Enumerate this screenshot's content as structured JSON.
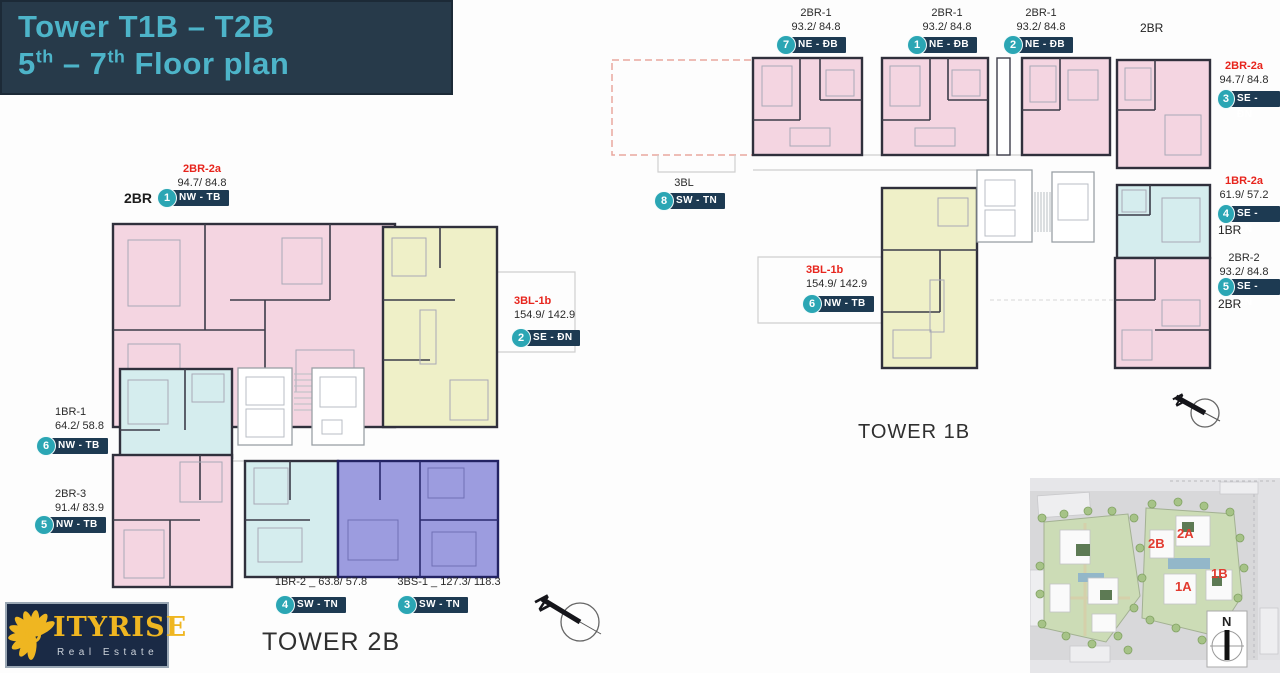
{
  "title": {
    "l1": "Tower T1B – T2B",
    "l2a": "5",
    "l2sup1": "th",
    "l2b": " – 7",
    "l2sup2": "th",
    "l2c": " Floor plan"
  },
  "north_letter": "N",
  "towers": {
    "t2b": {
      "name": "TOWER 2B",
      "labels": [
        {
          "code": "2BR-2a",
          "area": "94.7/ 84.8",
          "prefix": "2BR",
          "badge": "1",
          "dir": "NW - TB"
        },
        {
          "code": "3BL-1b",
          "area": "154.9/ 142.9",
          "badge": "2",
          "dir": "SE - ĐN"
        },
        {
          "code": "3BS-1 _ 127.3/ 118.3",
          "badge": "3",
          "dir": "SW - TN"
        },
        {
          "code": "1BR-2 _ 63.8/ 57.8",
          "badge": "4",
          "dir": "SW - TN"
        },
        {
          "code": "2BR-3",
          "area": "91.4/ 83.9",
          "badge": "5",
          "dir": "NW - TB"
        },
        {
          "code": "1BR-1",
          "area": "64.2/ 58.8",
          "badge": "6",
          "dir": "NW - TB"
        }
      ]
    },
    "t1b": {
      "name": "TOWER 1B",
      "corner_label": "2BR",
      "labels": [
        {
          "code": "2BR-1",
          "area": "93.2/ 84.8",
          "badge": "7",
          "dir": "NE - ĐB"
        },
        {
          "code": "2BR-1",
          "area": "93.2/ 84.8",
          "badge": "1",
          "dir": "NE - ĐB"
        },
        {
          "code": "2BR-1",
          "area": "93.2/ 84.8",
          "badge": "2",
          "dir": "NE - ĐB"
        },
        {
          "code": "2BR-2a",
          "area": "94.7/ 84.8",
          "badge": "3",
          "dir": "SE - ĐN"
        },
        {
          "code": "3BL",
          "badge": "8",
          "dir": "SW - TN"
        },
        {
          "code": "3BL-1b",
          "area": "154.9/ 142.9",
          "badge": "6",
          "dir": "NW - TB"
        },
        {
          "code": "1BR-2a",
          "area": "61.9/ 57.2",
          "badge": "4",
          "dir": "SE - ĐN",
          "suffix": "1BR"
        },
        {
          "code": "2BR-2",
          "area": "93.2/ 84.8",
          "badge": "5",
          "dir": "SE - ĐN",
          "suffix": "2BR"
        }
      ]
    }
  },
  "sitemap": {
    "labels": [
      {
        "t": "2B"
      },
      {
        "t": "2A"
      },
      {
        "t": "1B"
      },
      {
        "t": "1A"
      }
    ],
    "compass": "N"
  },
  "logo": {
    "word": "ITYRISE",
    "tagline": "Real Estate"
  },
  "palette": {
    "banner_bg": "#273a4a",
    "banner_text": "#4db4c9",
    "unit_pink": "#f4d5e1",
    "unit_cyan": "#d5edee",
    "unit_yellow": "#eff0c8",
    "unit_purple": "#9c9cdf",
    "badge_teal": "#2ba6b4",
    "pill_navy": "#1d3a52",
    "red_code": "#e7251d",
    "logo_navy": "#1a2a45",
    "logo_gold": "#efb621"
  }
}
